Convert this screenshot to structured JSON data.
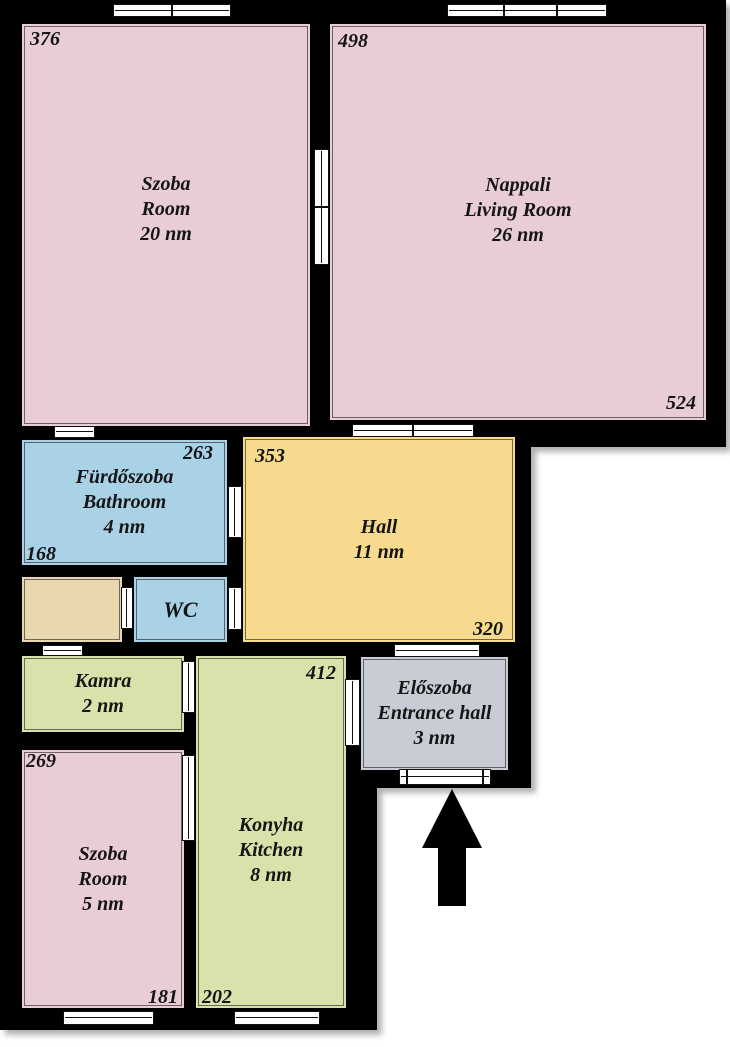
{
  "colors": {
    "wall": "#000000",
    "room_pink": "#e9cdd6",
    "room_blue": "#a9d2e7",
    "room_yellow": "#f7da8d",
    "room_green": "#d8e3ab",
    "room_tan": "#e9d7ad",
    "room_gray": "#c8ccd4",
    "opening": "#ffffff"
  },
  "rooms": {
    "szoba1": {
      "name_local": "Szoba",
      "name_en": "Room",
      "area": "20 nm",
      "dim_top_left": "376"
    },
    "nappali": {
      "name_local": "Nappali",
      "name_en": "Living Room",
      "area": "26 nm",
      "dim_top_left": "498",
      "dim_bottom_right": "524"
    },
    "bathroom": {
      "name_local": "Fürdőszoba",
      "name_en": "Bathroom",
      "area": "4 nm",
      "dim_top_right": "263",
      "dim_bottom_left": "168"
    },
    "hall": {
      "name_local": "Hall",
      "area": "11 nm",
      "dim_top_left": "353",
      "dim_bottom_right": "320"
    },
    "wc": {
      "name_local": "WC"
    },
    "kamra": {
      "name_local": "Kamra",
      "area": "2 nm"
    },
    "eloszoba": {
      "name_local": "Előszoba",
      "name_en": "Entrance hall",
      "area": "3 nm"
    },
    "szoba2": {
      "name_local": "Szoba",
      "name_en": "Room",
      "area": "5 nm",
      "dim_top_left": "269",
      "dim_bottom_right": "181"
    },
    "kitchen": {
      "name_local": "Konyha",
      "name_en": "Kitchen",
      "area": "8 nm",
      "dim_top_right": "412",
      "dim_bottom_left": "202"
    }
  },
  "icons": {
    "entrance_arrow": "up-arrow"
  }
}
